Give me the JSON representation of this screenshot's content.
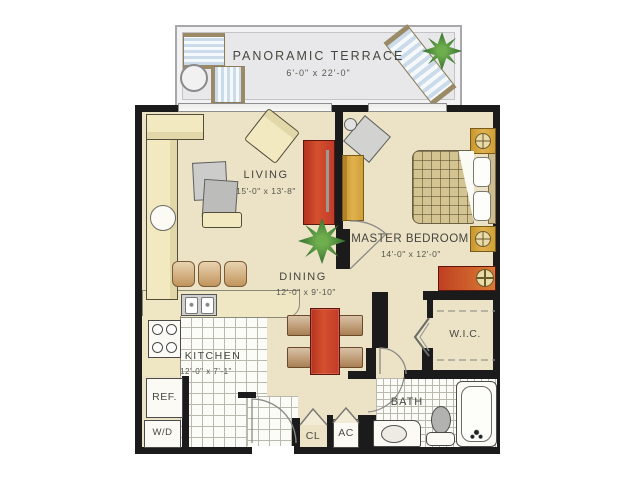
{
  "colors": {
    "wall": "#1b1b1b",
    "floor": "#ece3c6",
    "terrace_floor": "#e8e8ea",
    "tile_floor": "#fbfbf7",
    "accent_red": "#c23b2a",
    "accent_gold": "#d9a73a",
    "plant_green": "#3e7a36",
    "label_text": "#45453e"
  },
  "terrace": {
    "name": "PANORAMIC TERRACE",
    "dims": "6'-0\" x 22'-0\""
  },
  "rooms": {
    "living": {
      "name": "LIVING",
      "dims": "15'-0\" x 13'-8\""
    },
    "master_bedroom": {
      "name": "MASTER BEDROOM",
      "dims": "14'-0\" x 12'-0\""
    },
    "dining": {
      "name": "DINING",
      "dims": "12'-0\" x 9'-10\""
    },
    "kitchen": {
      "name": "KITCHEN",
      "dims": "12'-0\" x 7'-1\""
    },
    "walk_in_closet": {
      "name": "W.I.C."
    },
    "bath": {
      "name": "BATH"
    }
  },
  "fixtures": {
    "refrigerator": "REF.",
    "washer_dryer": "W/D",
    "closet": "CL",
    "air_conditioner": "AC"
  },
  "furniture_icons": [
    "sectional-sofa",
    "coffee-table",
    "ottoman",
    "armchair",
    "side-table",
    "tv-console",
    "bed",
    "pillow",
    "nightstand",
    "table-lamp",
    "dresser",
    "bench",
    "corner-chair",
    "plant",
    "dining-table",
    "dining-chair",
    "bar-stool",
    "kitchen-counter",
    "kitchen-sink",
    "stove",
    "refrigerator",
    "washer-dryer",
    "bathtub",
    "toilet",
    "vanity-sink",
    "lounge-chair",
    "patio-chair",
    "patio-table",
    "window",
    "door-swing",
    "bifold-door",
    "closet-rod"
  ]
}
